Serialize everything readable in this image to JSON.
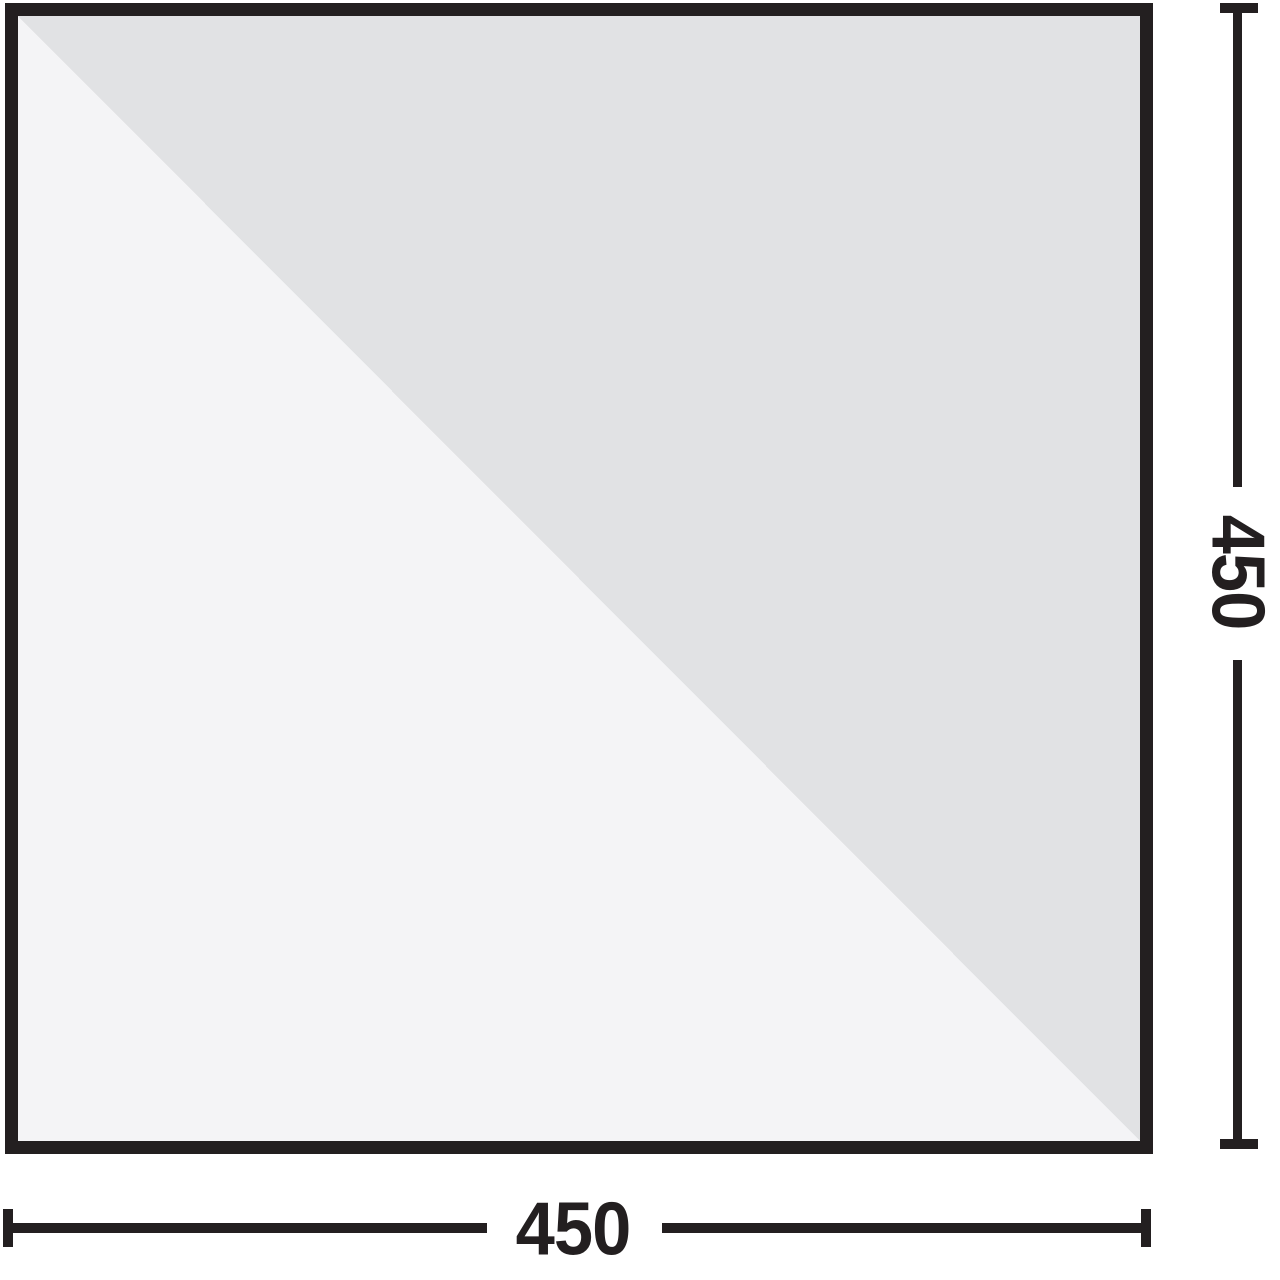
{
  "diagram": {
    "type": "dimension-diagram",
    "shape": "square",
    "dimensions": {
      "width_label": "450",
      "height_label": "450"
    },
    "colors": {
      "line": "#231f20",
      "fill_upper_triangle": "#e1e2e4",
      "fill_lower_triangle": "#f4f4f6",
      "background": "#ffffff"
    }
  }
}
